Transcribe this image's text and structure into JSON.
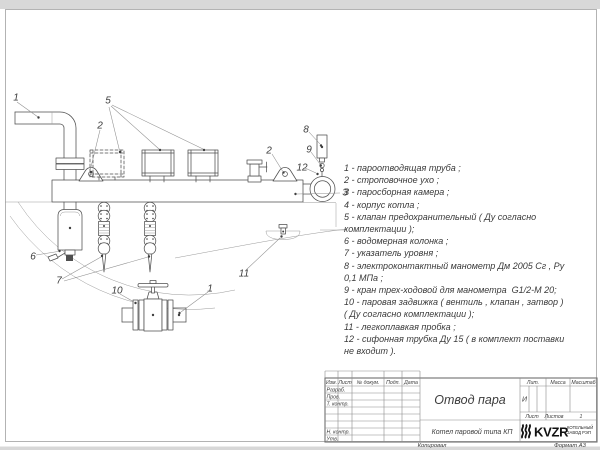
{
  "drawing": {
    "callouts": [
      {
        "n": "1",
        "x": 16,
        "y": 98
      },
      {
        "n": "2",
        "x": 100,
        "y": 126
      },
      {
        "n": "5",
        "x": 108,
        "y": 101
      },
      {
        "n": "2",
        "x": 269,
        "y": 151
      },
      {
        "n": "8",
        "x": 306,
        "y": 130
      },
      {
        "n": "9",
        "x": 309,
        "y": 150
      },
      {
        "n": "12",
        "x": 302,
        "y": 168
      },
      {
        "n": "3",
        "x": 345,
        "y": 193
      },
      {
        "n": "6",
        "x": 33,
        "y": 257
      },
      {
        "n": "7",
        "x": 59,
        "y": 281
      },
      {
        "n": "10",
        "x": 117,
        "y": 291
      },
      {
        "n": "1",
        "x": 210,
        "y": 289
      },
      {
        "n": "11",
        "x": 244,
        "y": 274
      }
    ]
  },
  "parts_list": {
    "items": [
      "1 - пароотводящая труба ;",
      "2 - строповочное ухо ;",
      "3 - паросборная камера ;",
      "4 - корпус котла ;",
      "5 - клапан предохранительный ( Ду согласно\nкомплектации );",
      "6 - водомерная колонка ;",
      "7 - указатель уровня ;",
      "8 - электроконтактный манометр Дм 2005 Сг , Ру\n0,1 МПа ;",
      "9 - кран трех-ходовой для манометра  G1/2-М 20;",
      "10 - паровая задвижка ( вентиль , клапан , затвор )\n( Ду согласно комплектации );",
      "11 - легкоплавкая пробка ;",
      "12 - сифонная трубка Ду 15 ( в комплект поставки\nне входит )."
    ]
  },
  "title_block": {
    "title": "Отвод пара",
    "subtitle": "Котел паровой типа КП",
    "columns": [
      "Изм.",
      "Лист",
      "№ докум.",
      "Подп.",
      "Дата"
    ],
    "rows": [
      "Разраб.",
      "Пров.",
      "Т. контр.",
      "Н. контр.",
      "Утв."
    ],
    "liter_label": "Лит.",
    "liter_value": "И",
    "mass_label": "Масса",
    "scale_label": "Масштаб",
    "sheet_label": "Лист",
    "sheets_label": "Листов",
    "sheets_value": "1",
    "logo_text": "KVZR",
    "logo_caption_line1": "КОТЕЛЬНЫЙ",
    "logo_caption_line2": "ЗАВОД РЭП"
  },
  "footer": {
    "copied_label": "Копировал",
    "format_label": "Формат А3"
  },
  "colors": {
    "line": "#4f4f4f",
    "thin_line": "#9a9a9a",
    "frame": "#b3b3b3",
    "logo": "#111111",
    "page_margin": "#d8d8d8"
  }
}
